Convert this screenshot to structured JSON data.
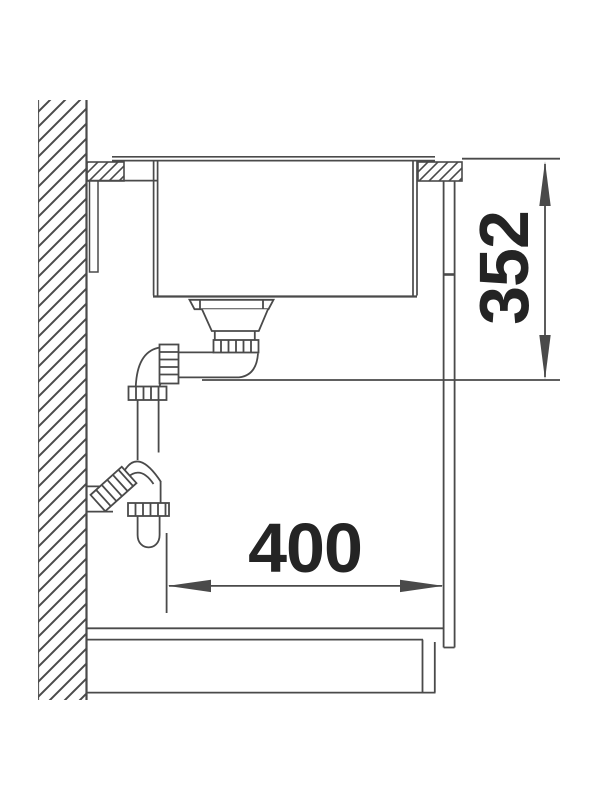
{
  "page": {
    "background": "#ffffff"
  },
  "drawing": {
    "subject": "sink-and-cabinet-cross-section",
    "line_color": "#4a4a4a",
    "text_color": "#242424",
    "dimensions": {
      "vertical": {
        "value": "352"
      },
      "horizontal": {
        "value": "400"
      }
    }
  }
}
